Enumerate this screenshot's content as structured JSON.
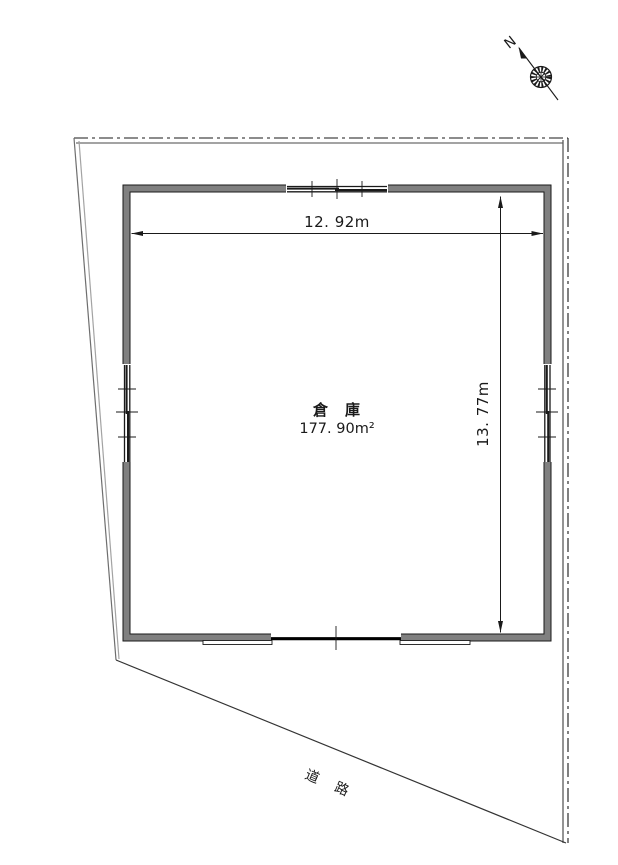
{
  "drawing": {
    "type": "site-plan",
    "building": {
      "name": "倉　庫",
      "area": "177. 90m²"
    },
    "dimensions": {
      "width": "12. 92m",
      "height": "13. 77m"
    },
    "road_label": "道　路",
    "north_label": "N"
  },
  "colors": {
    "wall_fill": "#808080",
    "line": "#1a1a1a",
    "boundary_gray": "#9a9a9a",
    "background": "#ffffff"
  }
}
